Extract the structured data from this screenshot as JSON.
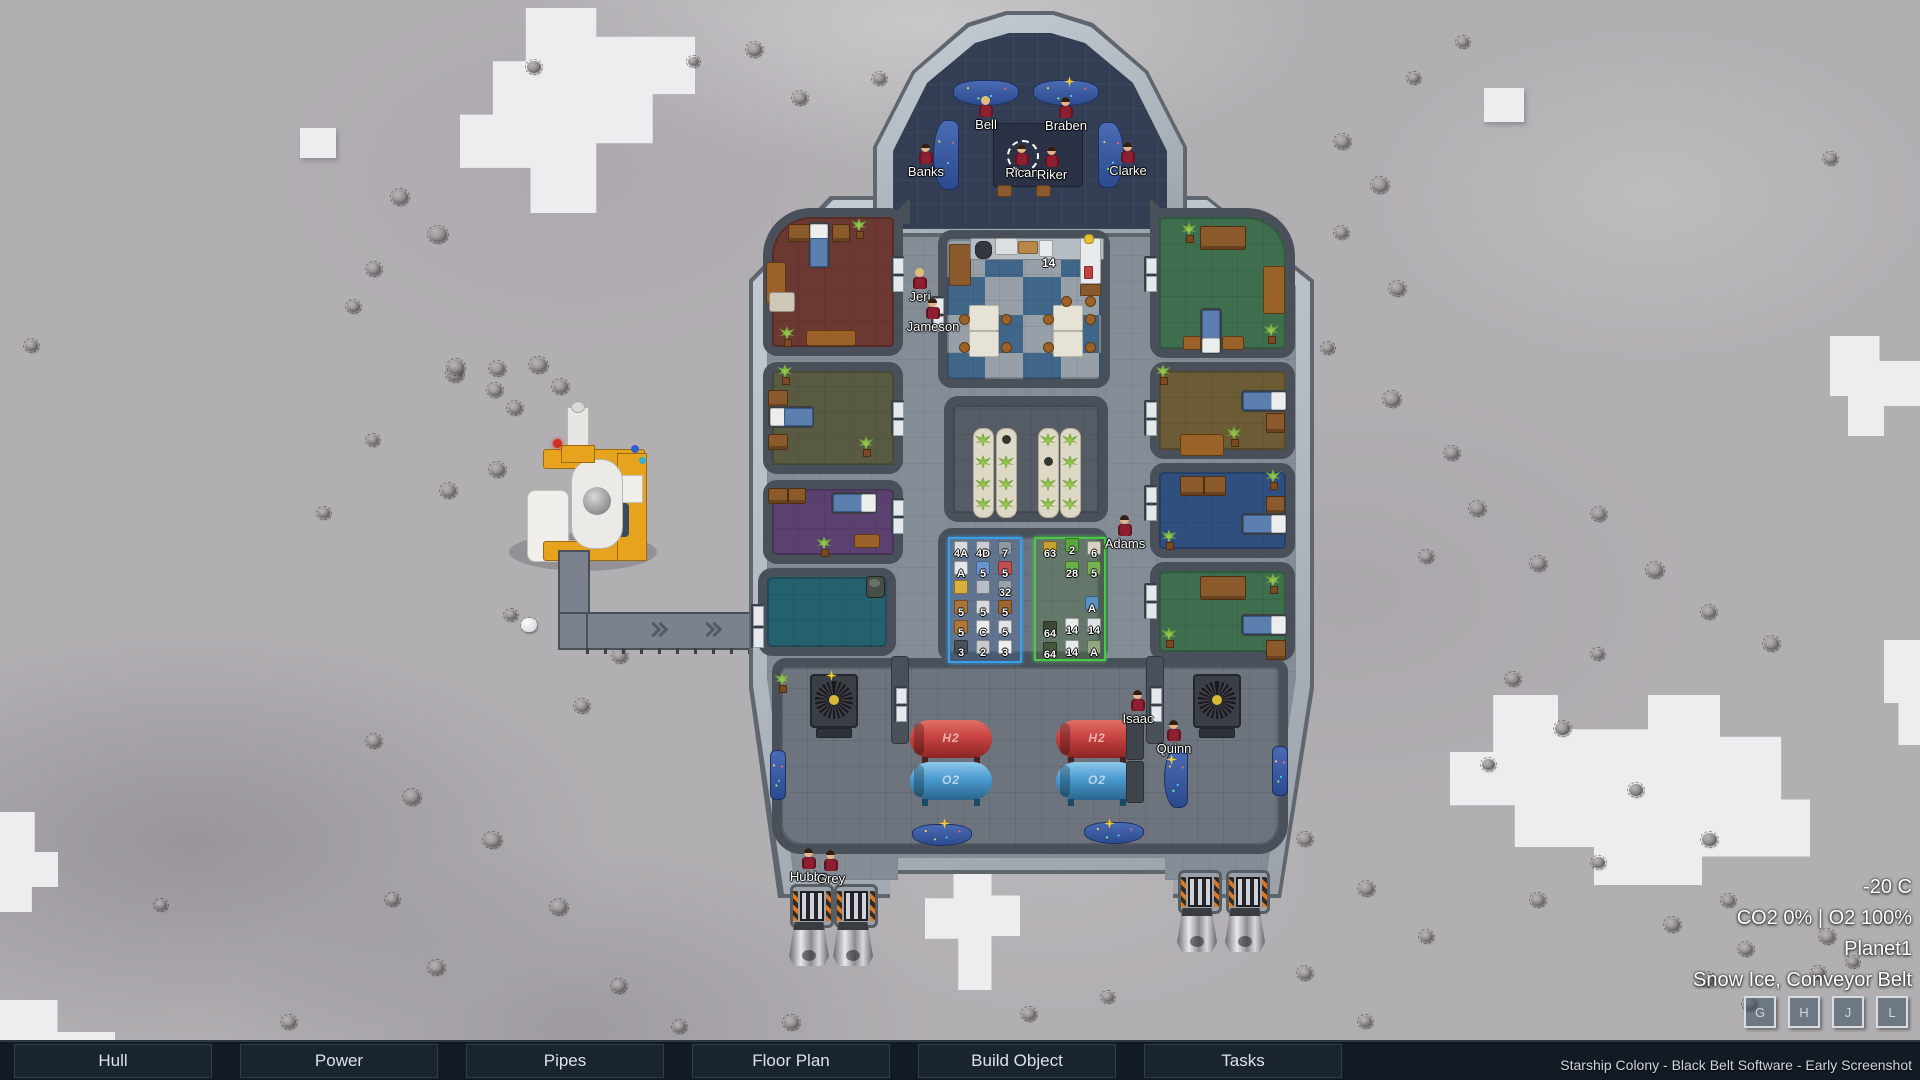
{
  "title": "Starship Colony",
  "menu": {
    "items": [
      "Hull",
      "Power",
      "Pipes",
      "Floor Plan",
      "Build Object",
      "Tasks"
    ]
  },
  "watermark": "Starship Colony - Black Belt Software - Early Screenshot",
  "hud": {
    "temperature": "-20 C",
    "atmosphere": "CO2 0% | O2 100%",
    "planet": "Planet1",
    "terrain_info": "Snow Ice, Conveyor Belt",
    "hotkeys": [
      "G",
      "H",
      "J",
      "L"
    ]
  },
  "crew": [
    {
      "name": "Bell",
      "x": 978,
      "y": 96,
      "hair": "blonde"
    },
    {
      "name": "Braben",
      "x": 1058,
      "y": 97,
      "hair": "dark"
    },
    {
      "name": "Banks",
      "x": 918,
      "y": 143,
      "hair": "dark"
    },
    {
      "name": "Rican",
      "x": 1014,
      "y": 144,
      "hair": "dark",
      "selected": true
    },
    {
      "name": "Riker",
      "x": 1044,
      "y": 146,
      "hair": "dark"
    },
    {
      "name": "Clarke",
      "x": 1120,
      "y": 142,
      "hair": "dark"
    },
    {
      "name": "Jeri",
      "x": 912,
      "y": 268,
      "hair": "blonde"
    },
    {
      "name": "Jameson",
      "x": 925,
      "y": 298,
      "hair": "dark"
    },
    {
      "name": "Adams",
      "x": 1117,
      "y": 515,
      "hair": "dark"
    },
    {
      "name": "Isaac",
      "x": 1130,
      "y": 690,
      "hair": "dark"
    },
    {
      "name": "Quinn",
      "x": 1166,
      "y": 720,
      "hair": "dark"
    },
    {
      "name": "Hubba",
      "x": 801,
      "y": 848,
      "hair": "dark"
    },
    {
      "name": "Grey",
      "x": 823,
      "y": 850,
      "hair": "dark"
    }
  ],
  "rooms": [
    {
      "name": "bedroom-red",
      "x": 763,
      "y": 208,
      "w": 140,
      "h": 148,
      "floor": "#6b3832",
      "tl": 48
    },
    {
      "name": "bedroom-olive",
      "x": 763,
      "y": 362,
      "w": 140,
      "h": 112,
      "floor": "#585b41"
    },
    {
      "name": "bedroom-purple",
      "x": 763,
      "y": 480,
      "w": 140,
      "h": 84,
      "floor": "#5b4170"
    },
    {
      "name": "storage-teal",
      "x": 758,
      "y": 568,
      "w": 138,
      "h": 88,
      "floor": "#25606f"
    },
    {
      "name": "mess-hall",
      "x": 938,
      "y": 230,
      "w": 172,
      "h": 158,
      "floor": "checker"
    },
    {
      "name": "hydroponics",
      "x": 944,
      "y": 396,
      "w": 164,
      "h": 126,
      "floor": "#565c66"
    },
    {
      "name": "storage-room",
      "x": 938,
      "y": 528,
      "w": 170,
      "h": 134,
      "floor": "#6c7380"
    },
    {
      "name": "bedroom-green-1",
      "x": 1150,
      "y": 208,
      "w": 145,
      "h": 150,
      "floor": "#3e6e4e",
      "tr": 48
    },
    {
      "name": "bedroom-tan",
      "x": 1150,
      "y": 362,
      "w": 145,
      "h": 97,
      "floor": "#6b5c36"
    },
    {
      "name": "bedroom-blue",
      "x": 1150,
      "y": 463,
      "w": 145,
      "h": 95,
      "floor": "#2f4f7e"
    },
    {
      "name": "bedroom-green-2",
      "x": 1150,
      "y": 562,
      "w": 145,
      "h": 99,
      "floor": "#3e6e4e"
    },
    {
      "name": "engine-room",
      "x": 772,
      "y": 658,
      "w": 516,
      "h": 196,
      "floor": "#6d747e",
      "br": 30
    }
  ],
  "objects": [
    [
      "bed",
      808,
      222,
      "v"
    ],
    [
      "dr",
      788,
      224,
      20,
      16
    ],
    [
      "dr",
      832,
      224,
      16,
      16
    ],
    [
      "pl",
      851,
      218
    ],
    [
      "tbl",
      766,
      262,
      18,
      40
    ],
    [
      "rect",
      769,
      292,
      24,
      18,
      "#cfc8b8",
      3
    ],
    [
      "tbl",
      806,
      330,
      48,
      14
    ],
    [
      "pl",
      779,
      326
    ],
    [
      "pl",
      777,
      364
    ],
    [
      "dr",
      768,
      390,
      18,
      16
    ],
    [
      "bed",
      768,
      406,
      "h"
    ],
    [
      "dr",
      768,
      434,
      18,
      14
    ],
    [
      "pl",
      858,
      436
    ],
    [
      "dr",
      768,
      488,
      18,
      14
    ],
    [
      "dr",
      788,
      488,
      16,
      14
    ],
    [
      "bed",
      831,
      492,
      "hr"
    ],
    [
      "pl",
      816,
      536
    ],
    [
      "tbl",
      854,
      534,
      24,
      12
    ],
    [
      "barrel",
      866,
      576
    ],
    [
      "rect",
      949,
      244,
      20,
      40,
      "#8a5a2c",
      2
    ],
    [
      "rect",
      970,
      238,
      132,
      20,
      "#b6bcc4",
      2
    ],
    [
      "rect",
      975,
      241,
      15,
      16,
      "#33383e",
      7
    ],
    [
      "rect",
      995,
      238,
      21,
      15,
      "#dcdee0",
      2
    ],
    [
      "rect",
      1018,
      241,
      18,
      11,
      "#b88848",
      2
    ],
    [
      "rect",
      1039,
      240,
      12,
      15,
      "#e8eaec",
      2
    ],
    [
      "rect",
      1080,
      238,
      19,
      44,
      "#e8eaec",
      2
    ],
    [
      "rect",
      1084,
      234,
      8,
      8,
      "#e8c030",
      4
    ],
    [
      "rect",
      1084,
      266,
      7,
      11,
      "#c04040",
      1
    ],
    [
      "rect",
      1080,
      284,
      19,
      10,
      "#8a5a2c",
      1
    ],
    [
      "wt",
      969,
      305
    ],
    [
      "wt",
      969,
      331
    ],
    [
      "wt",
      1053,
      305
    ],
    [
      "wt",
      1053,
      331
    ],
    [
      "st",
      959,
      314
    ],
    [
      "st",
      1001,
      314
    ],
    [
      "st",
      959,
      342
    ],
    [
      "st",
      1001,
      342
    ],
    [
      "st",
      1043,
      314
    ],
    [
      "st",
      1085,
      314
    ],
    [
      "st",
      1043,
      342
    ],
    [
      "st",
      1085,
      342
    ],
    [
      "st",
      1061,
      296
    ],
    [
      "st",
      1085,
      296
    ],
    [
      "olabel",
      1042,
      256,
      "14"
    ],
    [
      "trough",
      973,
      428,
      -1
    ],
    [
      "trough",
      996,
      428,
      0
    ],
    [
      "trough",
      1038,
      428,
      1
    ],
    [
      "trough",
      1060,
      428,
      -1
    ],
    [
      "pl",
      1181,
      222
    ],
    [
      "dr",
      1200,
      226,
      44,
      22
    ],
    [
      "tbl",
      1263,
      266,
      20,
      46
    ],
    [
      "bed",
      1200,
      308,
      "vd"
    ],
    [
      "tbl",
      1183,
      336,
      16,
      12
    ],
    [
      "tbl",
      1222,
      336,
      20,
      12
    ],
    [
      "pl",
      1263,
      323
    ],
    [
      "pl",
      1155,
      364
    ],
    [
      "bed",
      1241,
      390,
      "hr"
    ],
    [
      "dr",
      1266,
      413,
      17,
      18
    ],
    [
      "tbl",
      1180,
      434,
      42,
      20
    ],
    [
      "pl",
      1226,
      426
    ],
    [
      "dr",
      1180,
      476,
      22,
      18
    ],
    [
      "dr",
      1204,
      476,
      20,
      18
    ],
    [
      "pl",
      1265,
      469
    ],
    [
      "dr",
      1266,
      496,
      17,
      16
    ],
    [
      "bed",
      1241,
      513,
      "hr"
    ],
    [
      "pl",
      1161,
      529
    ],
    [
      "dr",
      1200,
      576,
      44,
      22
    ],
    [
      "pl",
      1265,
      573
    ],
    [
      "bed",
      1241,
      614,
      "hr"
    ],
    [
      "dr",
      1266,
      640,
      18,
      18
    ],
    [
      "pl",
      1161,
      627
    ],
    [
      "pl",
      774,
      672
    ],
    [
      "fan",
      810,
      674
    ],
    [
      "fan",
      1193,
      674
    ],
    [
      "rect",
      816,
      728,
      34,
      8,
      "#2e3238",
      2
    ],
    [
      "rect",
      1199,
      728,
      34,
      8,
      "#2e3238",
      2
    ],
    [
      "tank",
      910,
      720,
      "red",
      "H2"
    ],
    [
      "tank",
      1056,
      720,
      "red",
      "H2"
    ],
    [
      "tank",
      910,
      762,
      "blue",
      "O2"
    ],
    [
      "tank",
      1056,
      762,
      "blue",
      "O2"
    ],
    [
      "rect",
      1126,
      718,
      16,
      40,
      "#3f444b",
      3
    ],
    [
      "rect",
      1126,
      761,
      16,
      40,
      "#3f444b",
      3
    ],
    [
      "rect",
      891,
      656,
      16,
      86,
      "#49505a",
      4
    ],
    [
      "rect",
      1146,
      656,
      16,
      86,
      "#49505a",
      4
    ],
    [
      "console",
      770,
      750,
      14,
      48,
      "v"
    ],
    [
      "console",
      1272,
      746,
      14,
      48,
      "v"
    ],
    [
      "console",
      1164,
      748,
      22,
      58,
      "cl"
    ],
    [
      "console",
      912,
      824,
      58,
      20,
      "arc"
    ],
    [
      "console",
      1084,
      822,
      58,
      20,
      "arc"
    ],
    [
      "console",
      953,
      80,
      64,
      24,
      "arc"
    ],
    [
      "console",
      1033,
      80,
      64,
      24,
      "arc"
    ],
    [
      "console",
      933,
      120,
      24,
      68,
      "cl"
    ],
    [
      "console",
      1098,
      122,
      24,
      64,
      "cr"
    ],
    [
      "rect",
      993,
      123,
      88,
      62,
      "#2b3246",
      3
    ],
    [
      "rect",
      997,
      185,
      13,
      10,
      "#8a5a2c",
      3
    ],
    [
      "rect",
      1036,
      185,
      13,
      10,
      "#8a5a2c",
      3
    ],
    [
      "spark",
      1064,
      76
    ],
    [
      "spark",
      826,
      670
    ],
    [
      "spark",
      939,
      818
    ],
    [
      "spark",
      1104,
      818
    ],
    [
      "spark",
      1166,
      754
    ],
    [
      "door",
      891,
      256,
      0
    ],
    [
      "door",
      891,
      400,
      0
    ],
    [
      "door",
      891,
      498,
      0
    ],
    [
      "door",
      751,
      604,
      1
    ],
    [
      "door",
      931,
      296,
      0
    ],
    [
      "door",
      1144,
      256,
      0
    ],
    [
      "door",
      1144,
      400,
      0
    ],
    [
      "door",
      1144,
      485,
      0
    ],
    [
      "door",
      1144,
      583,
      0
    ],
    [
      "door",
      894,
      686,
      0
    ],
    [
      "door",
      1149,
      686,
      0
    ]
  ],
  "storage_zones": [
    {
      "name": "blue-zone",
      "x": 948,
      "y": 537,
      "w": 70,
      "h": 122,
      "border": "#38a0e8",
      "bg": "rgba(70,120,180,0.30)",
      "items": [
        [
          951,
          541,
          "#d8dce0",
          "4A"
        ],
        [
          973,
          541,
          "#c8ccd4",
          "4D"
        ],
        [
          995,
          541,
          "#8e98a2",
          "7"
        ],
        [
          951,
          561,
          "#e4e6ea",
          "A"
        ],
        [
          973,
          561,
          "#6a94d0",
          "5"
        ],
        [
          995,
          561,
          "#c05050",
          "5"
        ],
        [
          951,
          580,
          "#d8b040",
          ""
        ],
        [
          973,
          580,
          "#b8bec8",
          ""
        ],
        [
          995,
          580,
          "#9aa2ac",
          "32"
        ],
        [
          951,
          600,
          "#a8743a",
          "5"
        ],
        [
          973,
          600,
          "#d8dade",
          "5"
        ],
        [
          995,
          600,
          "#9a6830",
          "5"
        ],
        [
          951,
          620,
          "#b07838",
          "5"
        ],
        [
          973,
          620,
          "#e8eaec",
          "C"
        ],
        [
          995,
          620,
          "#dfe2e6",
          "5"
        ],
        [
          951,
          640,
          "#4a505a",
          "3"
        ],
        [
          973,
          640,
          "#c8ccd2",
          "2"
        ],
        [
          995,
          640,
          "#eceef0",
          "3"
        ]
      ]
    },
    {
      "name": "green-zone",
      "x": 1034,
      "y": 537,
      "w": 68,
      "h": 120,
      "border": "#48c848",
      "bg": "rgba(80,130,60,0.30)",
      "items": [
        [
          1040,
          541,
          "#c8a030",
          "63"
        ],
        [
          1062,
          538,
          "#58a840",
          "2"
        ],
        [
          1084,
          541,
          "#d8d0c0",
          "6"
        ],
        [
          1062,
          561,
          "#68b048",
          "28"
        ],
        [
          1084,
          561,
          "#78b050",
          "5"
        ],
        [
          1082,
          596,
          "#5890c0",
          "A"
        ],
        [
          1040,
          621,
          "#3c4836",
          "64"
        ],
        [
          1062,
          618,
          "#e8ecee",
          "14"
        ],
        [
          1084,
          618,
          "#dce2e6",
          "14"
        ],
        [
          1040,
          642,
          "#48563e",
          "64"
        ],
        [
          1062,
          640,
          "#e6eaec",
          "14"
        ],
        [
          1084,
          640,
          "#90a880",
          "A"
        ]
      ]
    }
  ],
  "belt": {
    "arrows_out": [
      648,
      702,
      750
    ],
    "arrows_in": [
      812,
      842
    ]
  },
  "terrain": {
    "rocks": [
      [
        392,
        190,
        16
      ],
      [
        429,
        227,
        18
      ],
      [
        367,
        263,
        14
      ],
      [
        347,
        301,
        13
      ],
      [
        447,
        367,
        16
      ],
      [
        367,
        435,
        12
      ],
      [
        441,
        484,
        15
      ],
      [
        318,
        508,
        12
      ],
      [
        25,
        340,
        13
      ],
      [
        527,
        61,
        14
      ],
      [
        747,
        43,
        15
      ],
      [
        793,
        92,
        14
      ],
      [
        688,
        57,
        11
      ],
      [
        873,
        73,
        13
      ],
      [
        1824,
        153,
        13
      ],
      [
        448,
        360,
        16
      ],
      [
        490,
        362,
        15
      ],
      [
        530,
        358,
        17
      ],
      [
        488,
        384,
        14
      ],
      [
        553,
        380,
        15
      ],
      [
        508,
        402,
        14
      ],
      [
        490,
        463,
        15
      ],
      [
        505,
        610,
        12
      ],
      [
        613,
        650,
        14
      ],
      [
        575,
        700,
        14
      ],
      [
        367,
        735,
        14
      ],
      [
        404,
        790,
        16
      ],
      [
        484,
        833,
        17
      ],
      [
        386,
        894,
        13
      ],
      [
        429,
        961,
        15
      ],
      [
        551,
        900,
        16
      ],
      [
        612,
        980,
        14
      ],
      [
        673,
        1021,
        13
      ],
      [
        784,
        1016,
        15
      ],
      [
        282,
        1016,
        14
      ],
      [
        155,
        900,
        12
      ],
      [
        1022,
        1008,
        14
      ],
      [
        1102,
        992,
        12
      ],
      [
        1335,
        135,
        15
      ],
      [
        1372,
        178,
        16
      ],
      [
        1335,
        227,
        13
      ],
      [
        1390,
        282,
        15
      ],
      [
        1322,
        343,
        12
      ],
      [
        1384,
        392,
        16
      ],
      [
        1445,
        447,
        14
      ],
      [
        1470,
        502,
        15
      ],
      [
        1420,
        551,
        13
      ],
      [
        1531,
        557,
        15
      ],
      [
        1592,
        508,
        14
      ],
      [
        1647,
        563,
        16
      ],
      [
        1702,
        606,
        14
      ],
      [
        1764,
        637,
        15
      ],
      [
        1592,
        649,
        12
      ],
      [
        1506,
        673,
        14
      ],
      [
        1555,
        722,
        15
      ],
      [
        1482,
        759,
        13
      ],
      [
        1629,
        784,
        14
      ],
      [
        1702,
        833,
        15
      ],
      [
        1592,
        857,
        13
      ],
      [
        1531,
        894,
        14
      ],
      [
        1665,
        918,
        15
      ],
      [
        1739,
        943,
        14
      ],
      [
        1812,
        967,
        13
      ],
      [
        1298,
        833,
        14
      ],
      [
        1359,
        882,
        15
      ],
      [
        1420,
        931,
        13
      ],
      [
        1298,
        967,
        14
      ],
      [
        1359,
        1016,
        13
      ],
      [
        1237,
        931,
        14
      ],
      [
        1722,
        895,
        13
      ],
      [
        1820,
        930,
        15
      ],
      [
        1847,
        957,
        12
      ],
      [
        1700,
        973,
        15
      ],
      [
        1743,
        998,
        14
      ],
      [
        1457,
        37,
        12
      ],
      [
        1408,
        73,
        12
      ]
    ],
    "belt_chunks": [
      [
        566,
        592,
        17
      ],
      [
        567,
        614,
        16
      ],
      [
        580,
        620,
        15
      ],
      [
        599,
        621,
        15
      ],
      [
        619,
        620,
        16
      ],
      [
        639,
        618,
        15
      ],
      [
        659,
        620,
        15
      ],
      [
        521,
        618,
        16
      ],
      [
        573,
        566,
        15
      ],
      [
        565,
        540,
        14
      ]
    ]
  }
}
